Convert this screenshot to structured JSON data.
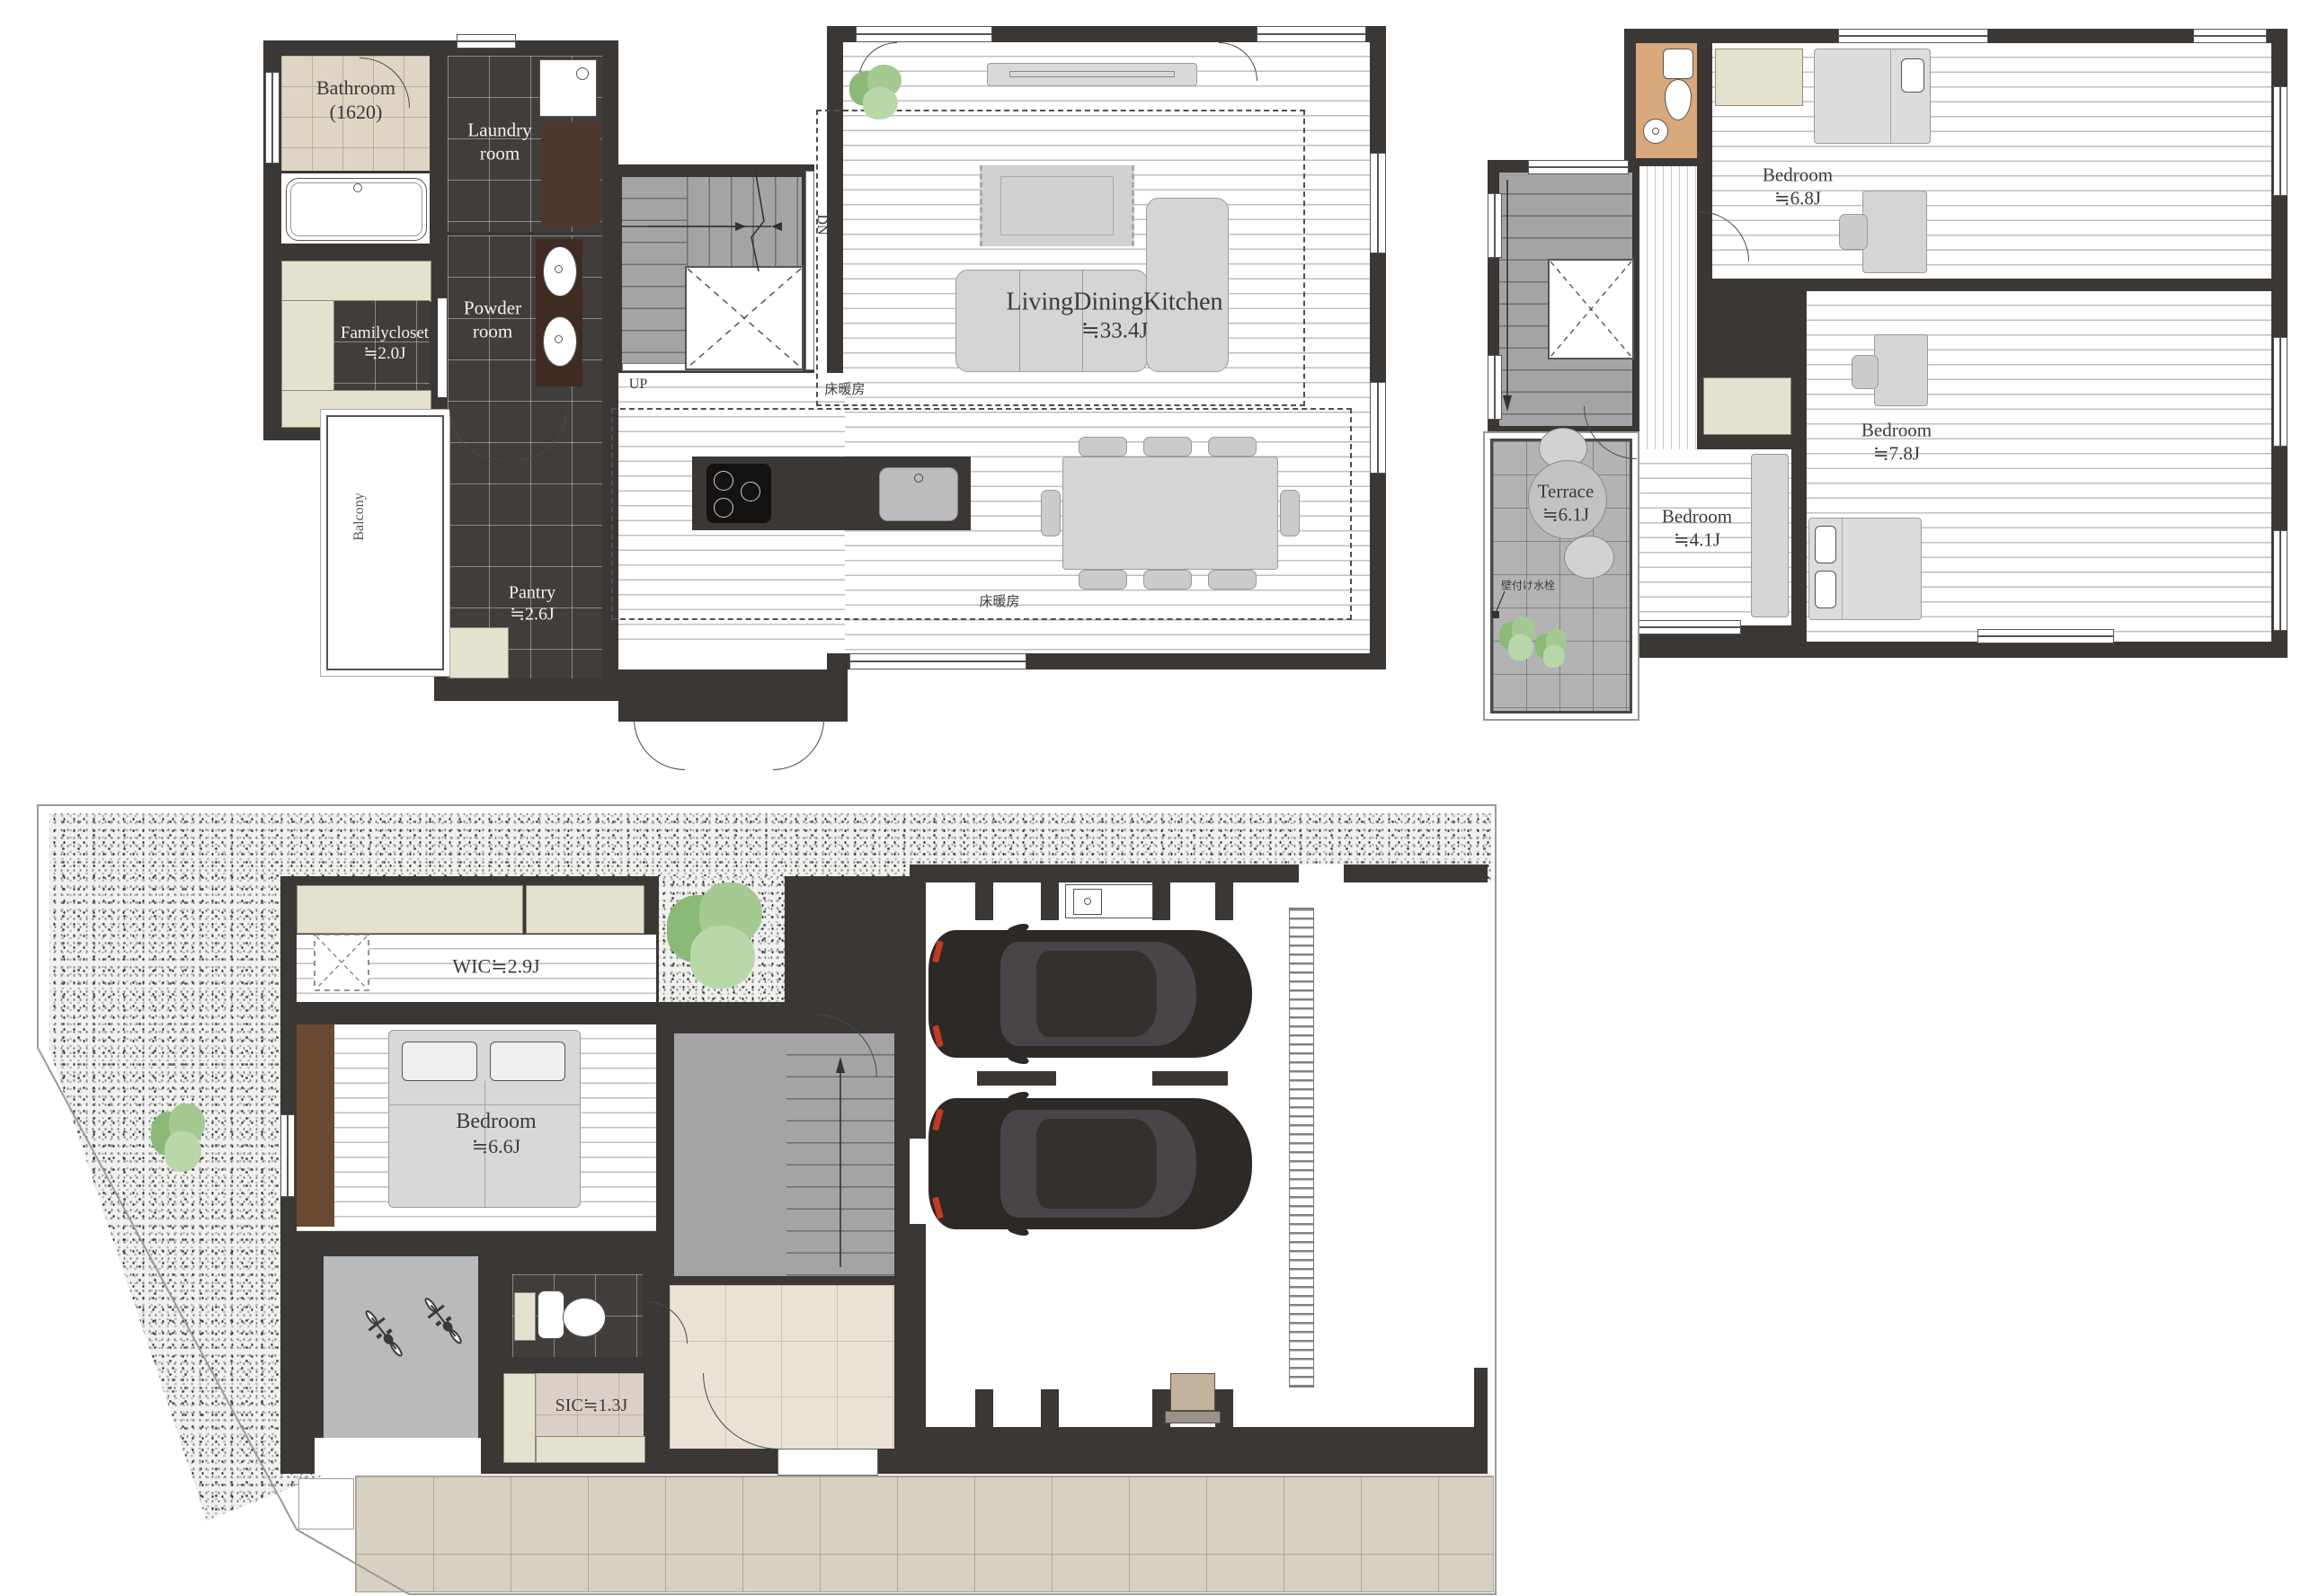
{
  "floor2": {
    "bathroom_name": "Bathroom",
    "bathroom_size": "(1620)",
    "laundry_line1": "Laundry",
    "laundry_line2": "room",
    "familycloset_name": "Familycloset",
    "familycloset_size": "≒2.0J",
    "powder_line1": "Powder",
    "powder_line2": "room",
    "balcony": "Balcony",
    "pantry_name": "Pantry",
    "pantry_size": "≒2.6J",
    "ldk_name": "LivingDiningKitchen",
    "ldk_size": "≒33.4J",
    "up": "UP",
    "dn": "DN",
    "floor_heating_1": "床暖房",
    "floor_heating_2": "床暖房"
  },
  "floor3": {
    "bedroom_a_name": "Bedroom",
    "bedroom_a_size": "≒6.8J",
    "bedroom_b_name": "Bedroom",
    "bedroom_b_size": "≒7.8J",
    "bedroom_c_name": "Bedroom",
    "bedroom_c_size": "≒4.1J",
    "terrace_name": "Terrace",
    "terrace_size": "≒6.1J",
    "faucet": "壁付け水栓"
  },
  "floor1": {
    "wic": "WIC≒2.9J",
    "bedroom_name": "Bedroom",
    "bedroom_size": "≒6.6J",
    "sic": "SIC≒1.3J"
  }
}
